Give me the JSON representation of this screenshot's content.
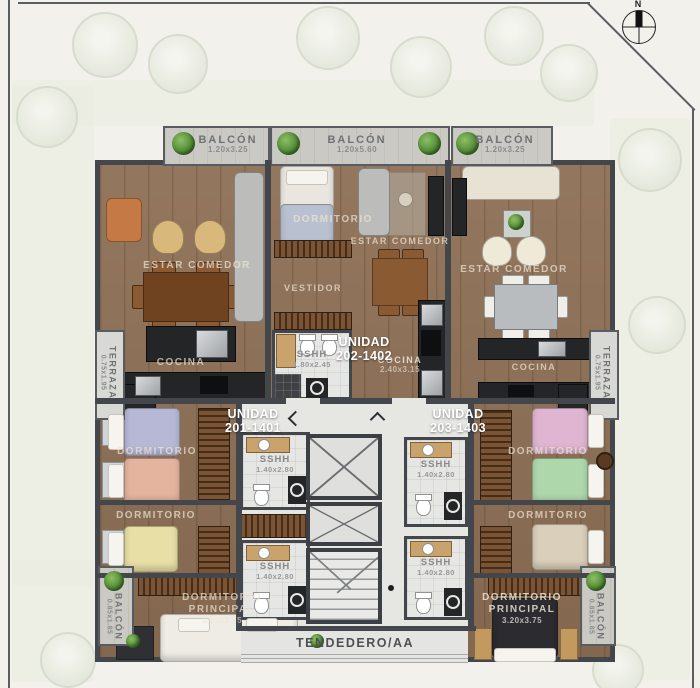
{
  "site": {
    "compass_label": "N"
  },
  "balconies": {
    "top_left": {
      "label": "BALCÓN",
      "dims": "1.20x3.25"
    },
    "top_center": {
      "label": "BALCÓN",
      "dims": "1.20x5.60"
    },
    "top_right": {
      "label": "BALCÓN",
      "dims": "1.20x3.25"
    },
    "bottom_left": {
      "label": "BALCÓN",
      "dims": "0.85x1.85"
    },
    "bottom_right": {
      "label": "BALCÓN",
      "dims": "0.85x1.85"
    }
  },
  "terraces": {
    "left": {
      "label": "TERRAZA",
      "dims": "0.75x1.95"
    },
    "right": {
      "label": "TERRAZA",
      "dims": "0.75x1.95"
    }
  },
  "units": {
    "u201": {
      "label": "UNIDAD",
      "number": "201-1401"
    },
    "u202": {
      "label": "UNIDAD",
      "number": "202-1402"
    },
    "u203": {
      "label": "UNIDAD",
      "number": "203-1403"
    }
  },
  "rooms": {
    "estar_comedor": "ESTAR COMEDOR",
    "cocina": "COCINA",
    "cocina_center_dims": "2.40x3.15",
    "dormitorio": "DORMITORIO",
    "vestidor": "VESTIDOR",
    "principal": "PRINCIPAL",
    "principal_dims": "3.20x3.75",
    "sshh": "SSHH",
    "sshh_center_dims": "1.80x2.45",
    "sshh_small_dims": "1.40x2.80",
    "tendedero": "TENDEDERO/AA"
  },
  "colors": {
    "wall": "#43474c",
    "wood": "#8d6f55",
    "tile": "#e6e6e4",
    "concrete": "#cac9c3",
    "counter": "#232527",
    "plant_green": "#49822f"
  }
}
